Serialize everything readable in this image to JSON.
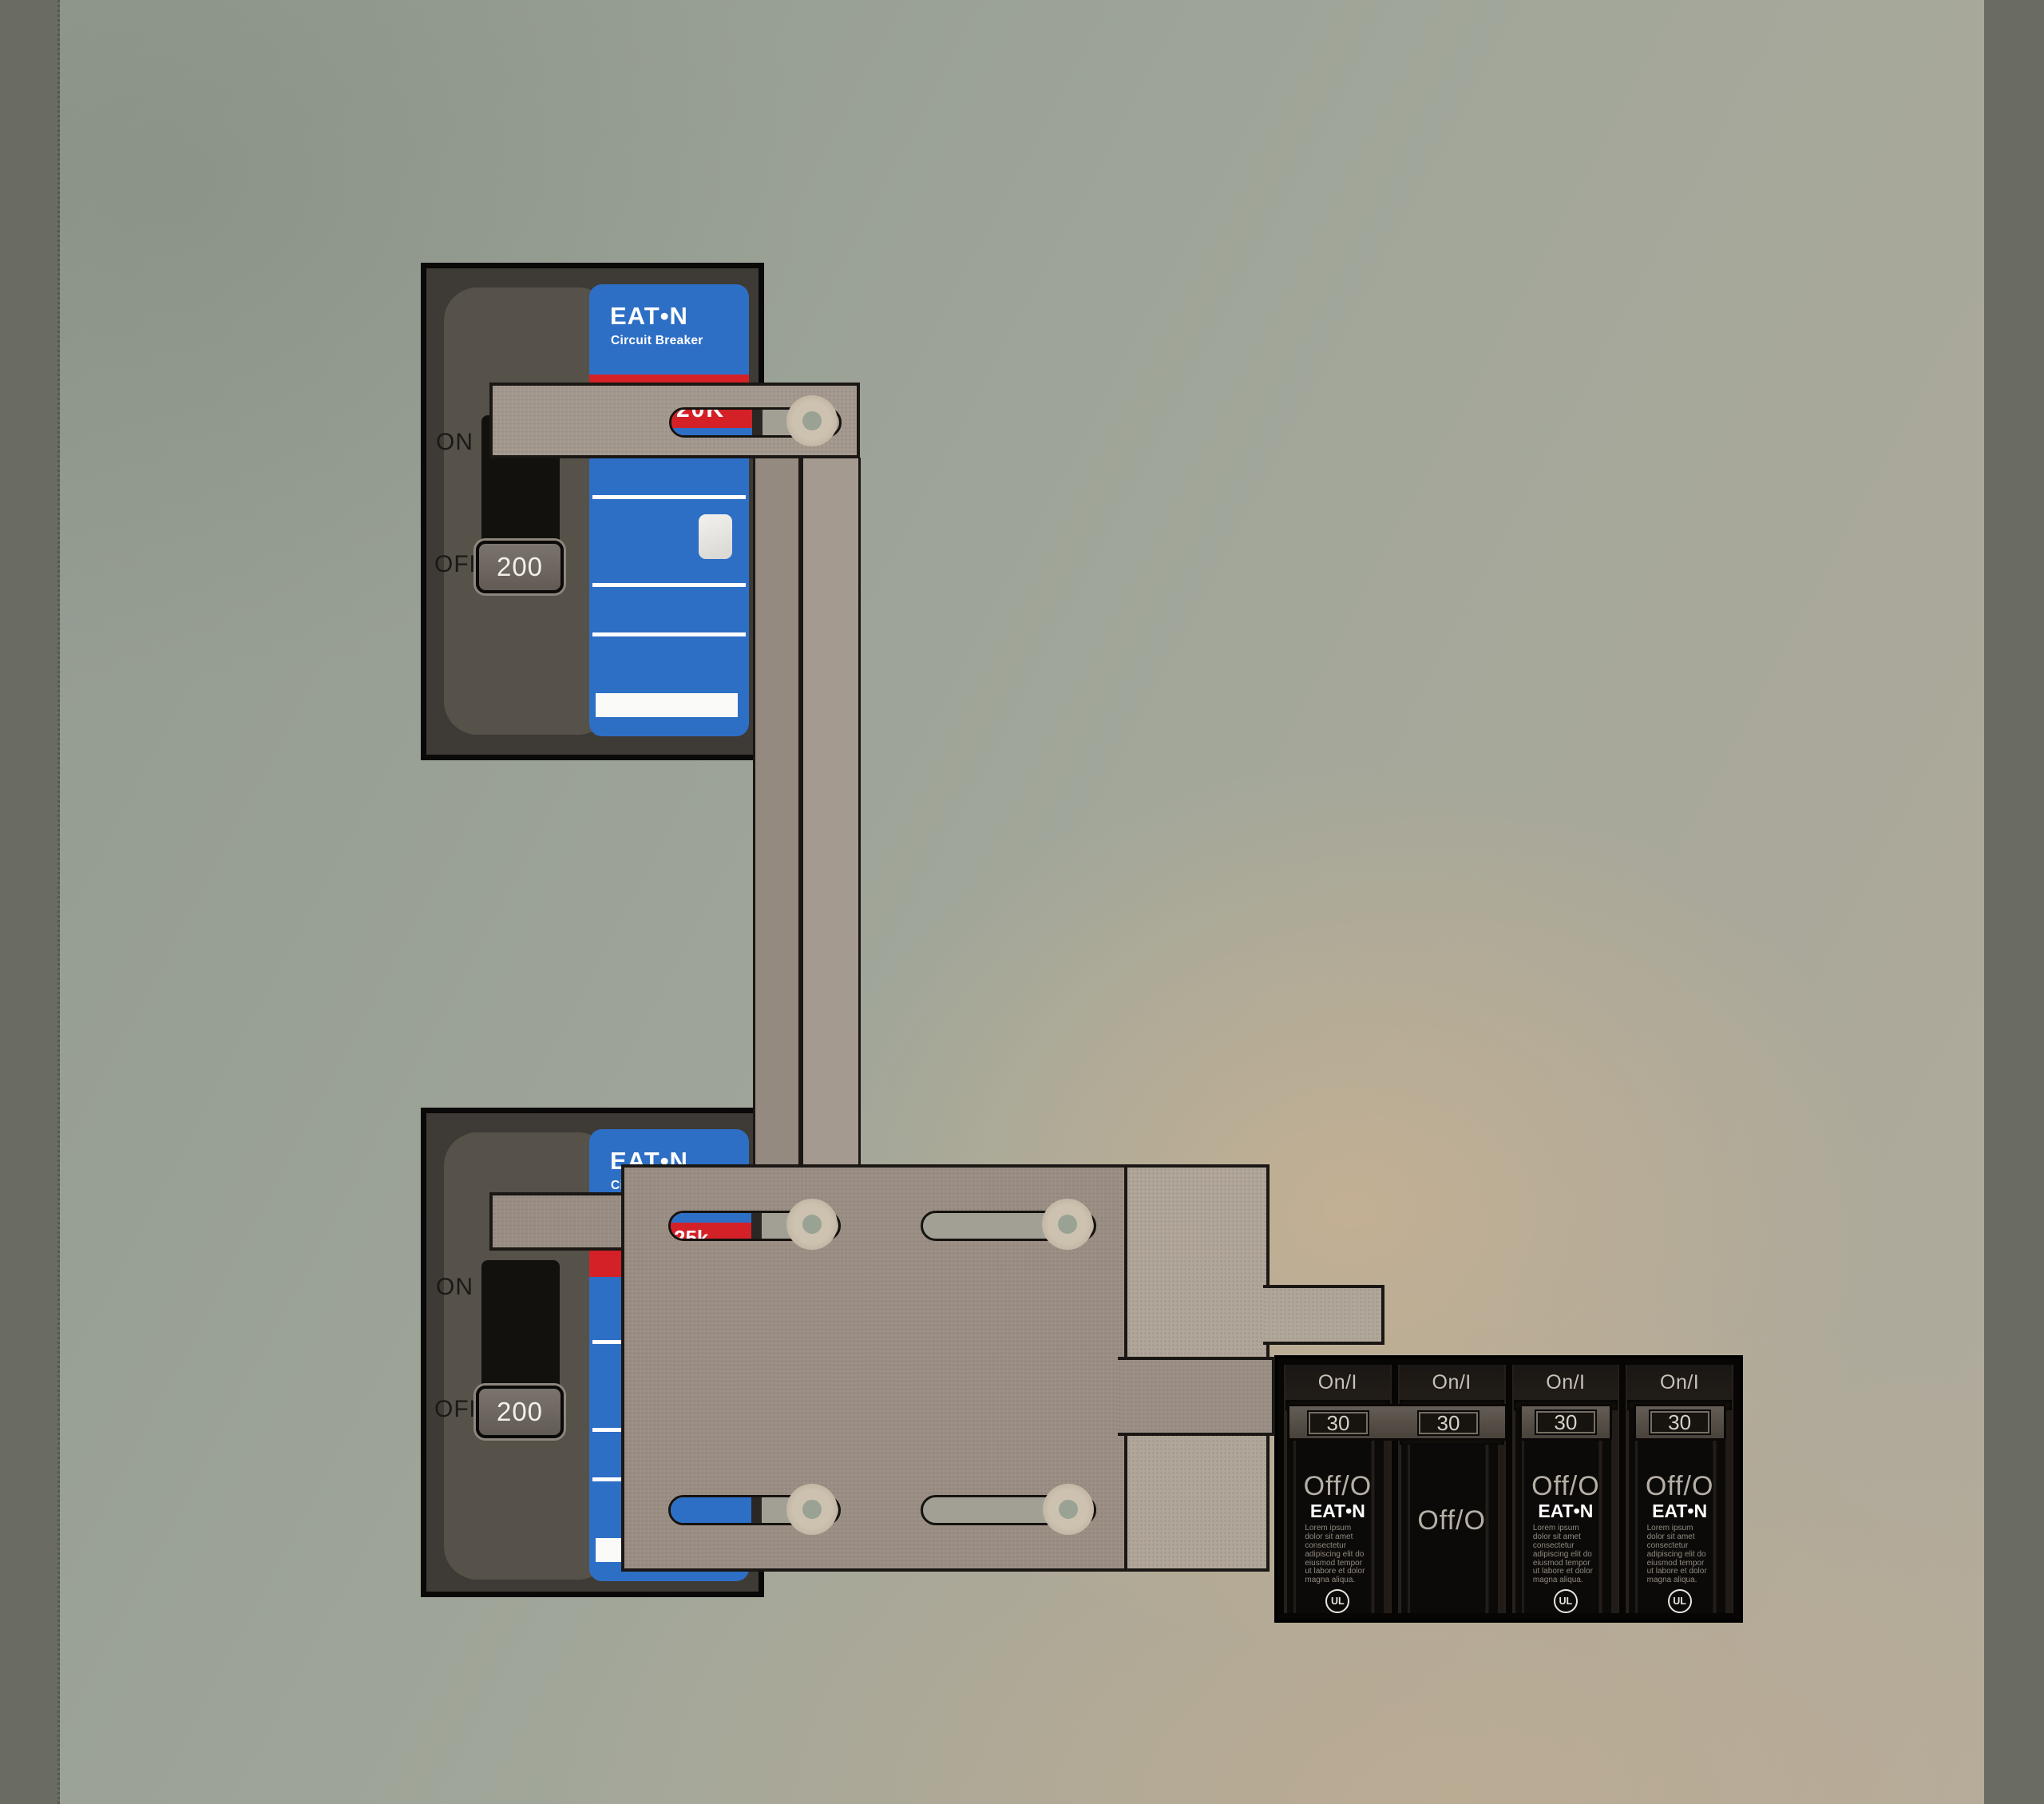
{
  "colors": {
    "eaton_blue": "#2e6fc6",
    "stripe_red": "#d42127",
    "plate_tan": "#9c9086",
    "slide_tan": "#b1a69a",
    "bar_tan": "#a59a8f",
    "strip_tan": "#948a80",
    "panel_body": "#3e3b36",
    "edge_band": "#6a6b62"
  },
  "main_breaker_top": {
    "on_label": "ON",
    "off_label": "OFF",
    "handle_amperage": "200",
    "brand": "EAT•N",
    "brand_subtitle": "Circuit Breaker",
    "interrupt_rating": "20K"
  },
  "main_breaker_bottom": {
    "on_label": "ON",
    "off_label": "OFF",
    "handle_amperage": "200",
    "brand": "EAT•N",
    "brand_subtitle": "Circuit Breaker",
    "interrupt_rating": "25k"
  },
  "branch_panel": {
    "units": [
      {
        "on_label": "On/I",
        "amperage": "30",
        "off_label": "Off/O",
        "brand": "EAT•N",
        "fine_print": "Lorem ipsum dolor sit amet consectetur adipiscing elit do eiusmod tempor ut labore et dolor magna aliqua.",
        "certification_mark": "UL"
      },
      {
        "on_label": "On/I",
        "amperage": "30",
        "off_label": "Off/O"
      },
      {
        "on_label": "On/I",
        "amperage": "30",
        "off_label": "Off/O",
        "brand": "EAT•N",
        "fine_print": "Lorem ipsum dolor sit amet consectetur adipiscing elit do eiusmod tempor ut labore et dolor magna aliqua.",
        "certification_mark": "UL"
      },
      {
        "on_label": "On/I",
        "amperage": "30",
        "off_label": "Off/O",
        "brand": "EAT•N",
        "fine_print": "Lorem ipsum dolor sit amet consectetur adipiscing elit do eiusmod tempor ut labore et dolor magna aliqua.",
        "certification_mark": "UL"
      }
    ]
  }
}
